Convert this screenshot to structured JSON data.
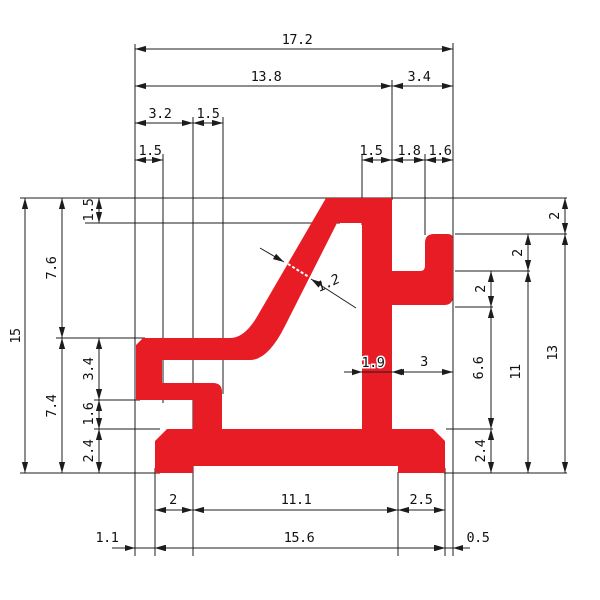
{
  "drawing": {
    "kind": "profile-cross-section-technical-drawing",
    "profile_color": "#e81c25",
    "line_color": "#1c1c1c",
    "dims": {
      "top": {
        "overall": "17.2",
        "left_span": "13.8",
        "right_span": "3.4",
        "notch_offset": "3.2",
        "notch_width": "1.5",
        "left_wall_width": "1.5",
        "bar_width_top": "1.5",
        "bar_to_tab_gap": "1.8",
        "tab_width": "1.6"
      },
      "left": {
        "overall_height": "15",
        "upper_height": "7.6",
        "lower_height": "7.4",
        "top_bar_thickness": "1.5",
        "arm_zone": "3.4",
        "neck_zone": "1.6",
        "base_thickness": "2.4"
      },
      "right": {
        "top_to_tab": "2",
        "tab_to_arm": "2",
        "arm_thickness": "2",
        "arm_to_base": "6.6",
        "base_thickness": "2.4",
        "arm_to_bottom": "11",
        "tab_to_bottom": "13"
      },
      "bottom": {
        "left_foot": "2",
        "recess_width": "11.1",
        "right_foot": "2.5",
        "base_width": "15.6",
        "left_offset": "1.1",
        "right_offset": "0.5"
      },
      "center": {
        "wall_thickness": "1.2",
        "bar_width": "1.9",
        "bar_to_edge": "3"
      }
    }
  }
}
